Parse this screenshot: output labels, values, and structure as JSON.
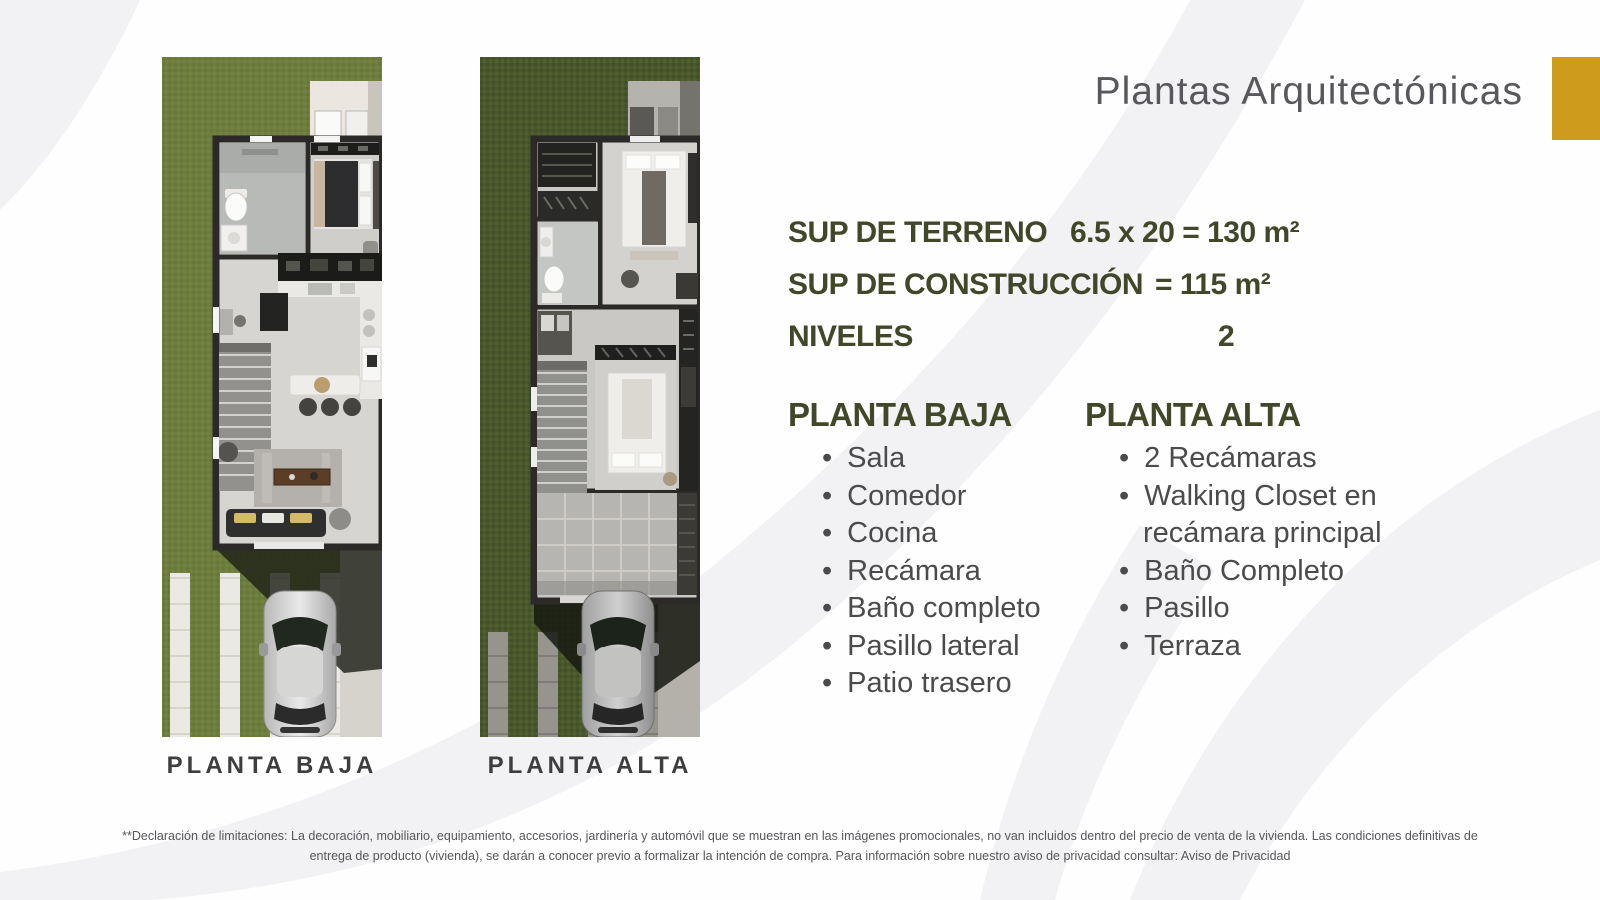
{
  "header": {
    "title": "Plantas Arquitectónicas"
  },
  "colors": {
    "accent_gold": "#CF9B1D",
    "heading_olive": "#414729",
    "list_gray": "#4B4B4B",
    "title_gray": "#58585C",
    "grass_ground_floor": "#6E7D3D",
    "grass_upper_floor": "#49572B"
  },
  "specs": {
    "rows": [
      {
        "label": "SUP DE TERRENO",
        "value": "6.5 x 20 = 130 m²"
      },
      {
        "label": "SUP DE CONSTRUCCIÓN",
        "value": "= 115 m²"
      },
      {
        "label": "NIVELES",
        "value": "2"
      }
    ]
  },
  "lists": {
    "baja": {
      "heading": "PLANTA BAJA",
      "items": [
        "Sala",
        "Comedor",
        "Cocina",
        "Recámara",
        "Baño completo",
        "Pasillo lateral",
        "Patio trasero"
      ]
    },
    "alta": {
      "heading": "PLANTA ALTA",
      "items": [
        "2 Recámaras",
        "Walking Closet en recámara principal",
        "Baño Completo",
        "Pasillo",
        "Terraza"
      ]
    }
  },
  "plans": {
    "baja_label": "PLANTA BAJA",
    "alta_label": "PLANTA ALTA"
  },
  "footer": {
    "line1": "**Declaración de limitaciones: La decoración, mobiliario, equipamiento, accesorios, jardinería y automóvil que se muestran en las imágenes promocionales, no van incluidos dentro del precio de venta de la vivienda. Las condiciones definitivas de",
    "line2": "entrega de producto (vivienda), se darán a conocer previo a formalizar la intención de compra. Para información sobre nuestro aviso de privacidad consultar: Aviso de Privacidad"
  }
}
